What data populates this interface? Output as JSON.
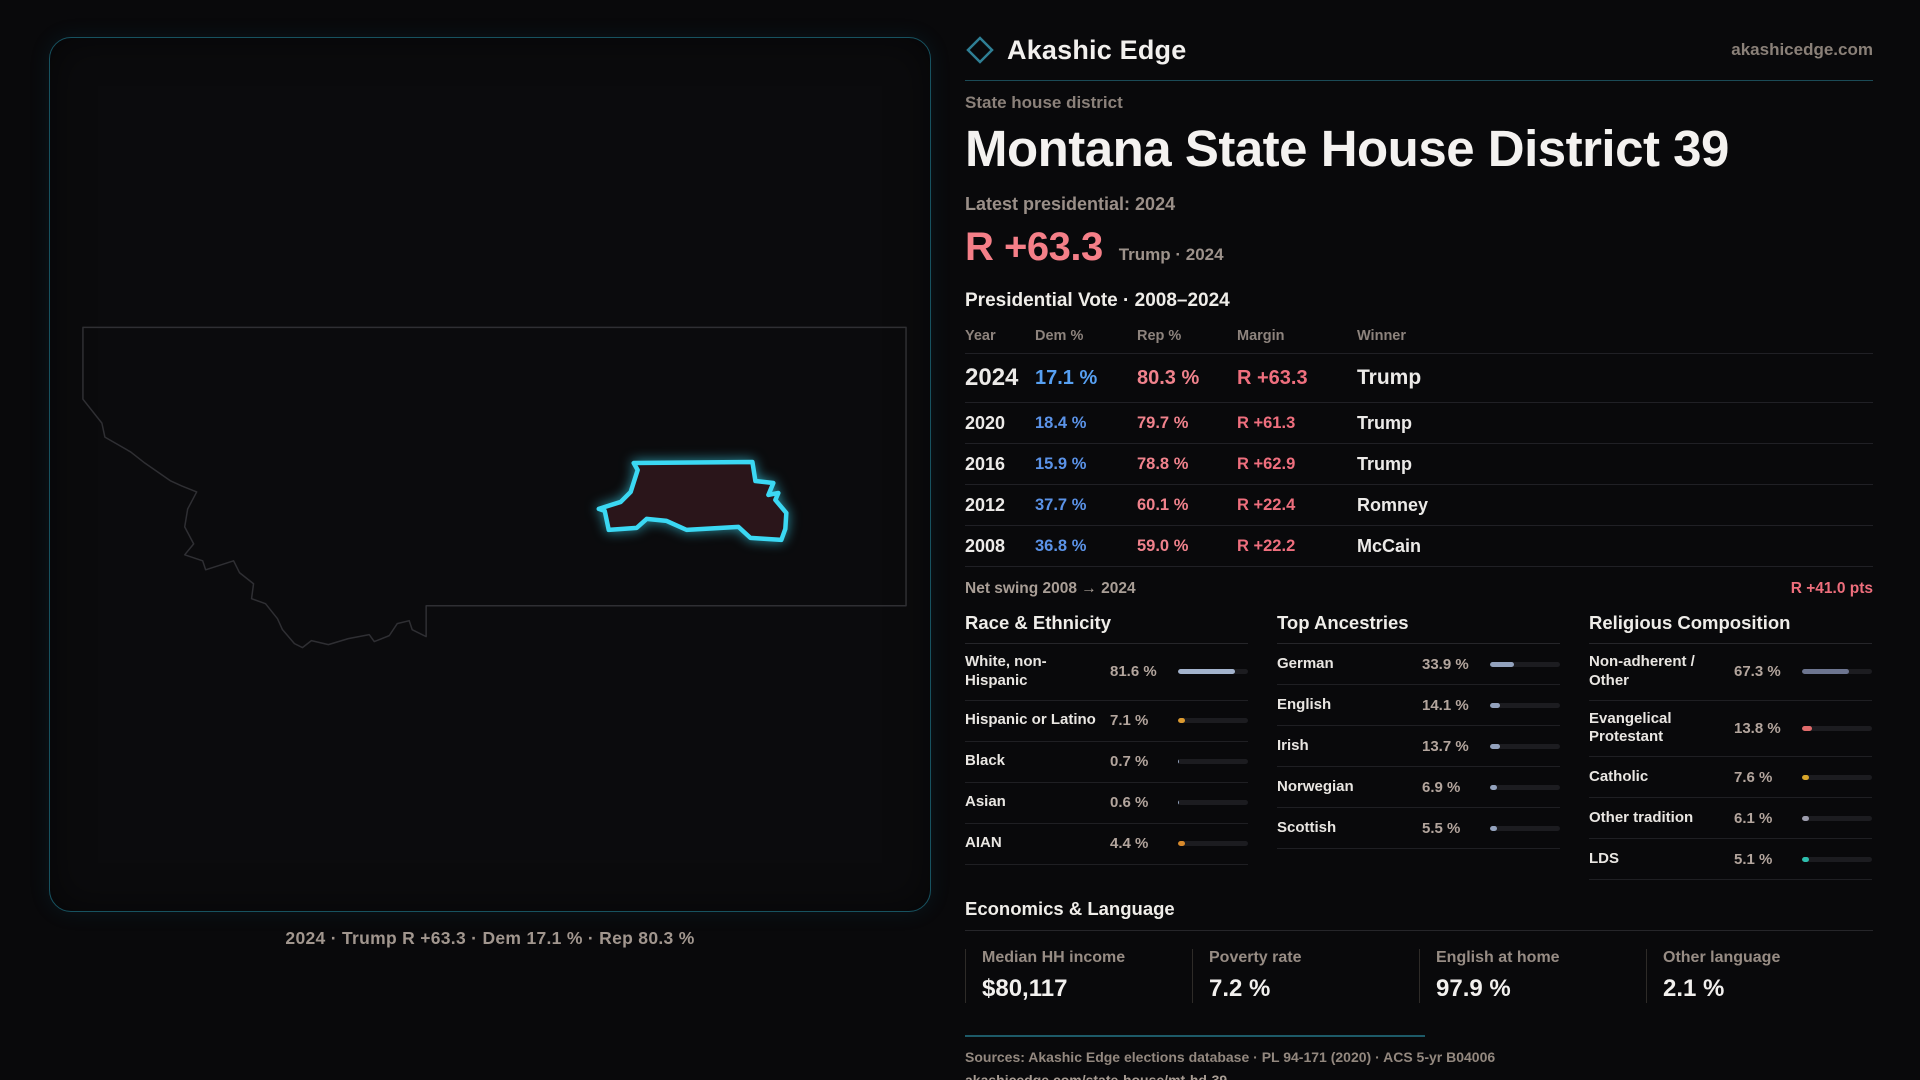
{
  "brand": {
    "name": "Akashic Edge",
    "site": "akashicedge.com",
    "diamond_color": "#2f7f95"
  },
  "header": {
    "kicker": "State house district",
    "title": "Montana State House District 39",
    "latest_label": "Latest presidential: 2024",
    "margin_big": "R +63.3",
    "margin_context": "Trump · 2024"
  },
  "map": {
    "caption": "2024 · Trump R +63.3 · Dem 17.1 % · Rep 80.3 %",
    "district_outline_color": "#3bd8f3",
    "district_fill_color": "#2a151a",
    "state_outline_color": "#2f2f33"
  },
  "table": {
    "title": "Presidential Vote · 2008–2024",
    "columns": [
      "Year",
      "Dem %",
      "Rep %",
      "Margin",
      "Winner"
    ],
    "rows": [
      {
        "year": "2024",
        "dem": "17.1 %",
        "rep": "80.3 %",
        "margin": "R +63.3",
        "winner": "Trump"
      },
      {
        "year": "2020",
        "dem": "18.4 %",
        "rep": "79.7 %",
        "margin": "R +61.3",
        "winner": "Trump"
      },
      {
        "year": "2016",
        "dem": "15.9 %",
        "rep": "78.8 %",
        "margin": "R +62.9",
        "winner": "Trump"
      },
      {
        "year": "2012",
        "dem": "37.7 %",
        "rep": "60.1 %",
        "margin": "R +22.4",
        "winner": "Romney"
      },
      {
        "year": "2008",
        "dem": "36.8 %",
        "rep": "59.0 %",
        "margin": "R +22.2",
        "winner": "McCain"
      }
    ],
    "net_swing_label": "Net swing 2008 → 2024",
    "net_swing_value": "R +41.0 pts"
  },
  "sections": [
    {
      "title": "Race & Ethnicity",
      "rows": [
        {
          "label": "White, non-Hispanic",
          "value": "81.6 %",
          "pct": 81.6,
          "color": "#a3b3cd"
        },
        {
          "label": "Hispanic or Latino",
          "value": "7.1 %",
          "pct": 7.1,
          "color": "#dc9a30"
        },
        {
          "label": "Black",
          "value": "0.7 %",
          "pct": 0.7,
          "color": "#93a2bd"
        },
        {
          "label": "Asian",
          "value": "0.6 %",
          "pct": 0.6,
          "color": "#93a2bd"
        },
        {
          "label": "AIAN",
          "value": "4.4 %",
          "pct": 4.4,
          "color": "#d88a2c"
        }
      ]
    },
    {
      "title": "Top Ancestries",
      "rows": [
        {
          "label": "German",
          "value": "33.9 %",
          "pct": 33.9,
          "color": "#93a2bd"
        },
        {
          "label": "English",
          "value": "14.1 %",
          "pct": 14.1,
          "color": "#93a2bd"
        },
        {
          "label": "Irish",
          "value": "13.7 %",
          "pct": 13.7,
          "color": "#93a2bd"
        },
        {
          "label": "Norwegian",
          "value": "6.9 %",
          "pct": 6.9,
          "color": "#93a2bd"
        },
        {
          "label": "Scottish",
          "value": "5.5 %",
          "pct": 5.5,
          "color": "#93a2bd"
        }
      ]
    },
    {
      "title": "Religious Composition",
      "rows": [
        {
          "label": "Non-adherent / Other",
          "value": "67.3 %",
          "pct": 67.3,
          "color": "#6d7590"
        },
        {
          "label": "Evangelical Protestant",
          "value": "13.8 %",
          "pct": 13.8,
          "color": "#e06b6b"
        },
        {
          "label": "Catholic",
          "value": "7.6 %",
          "pct": 7.6,
          "color": "#d9a62a"
        },
        {
          "label": "Other tradition",
          "value": "6.1 %",
          "pct": 6.1,
          "color": "#9c9cac"
        },
        {
          "label": "LDS",
          "value": "5.1 %",
          "pct": 5.1,
          "color": "#2dbfae"
        }
      ]
    }
  ],
  "economics": {
    "title": "Economics & Language",
    "stats": [
      {
        "label": "Median HH income",
        "value": "$80,117"
      },
      {
        "label": "Poverty rate",
        "value": "7.2 %"
      },
      {
        "label": "English at home",
        "value": "97.9 %"
      },
      {
        "label": "Other language",
        "value": "2.1 %"
      }
    ]
  },
  "footer": {
    "sources": "Sources: Akashic Edge elections database · PL 94-171 (2020) · ACS 5-yr B04006",
    "permalink": "akashicedge.com/state-house/mt-hd-39"
  },
  "chart_data": [
    {
      "type": "table",
      "title": "Presidential Vote · 2008–2024",
      "columns": [
        "Year",
        "Dem %",
        "Rep %",
        "Margin",
        "Winner"
      ],
      "rows": [
        [
          "2024",
          "17.1 %",
          "80.3 %",
          "R +63.3",
          "Trump"
        ],
        [
          "2020",
          "18.4 %",
          "79.7 %",
          "R +61.3",
          "Trump"
        ],
        [
          "2016",
          "15.9 %",
          "78.8 %",
          "R +62.9",
          "Trump"
        ],
        [
          "2012",
          "37.7 %",
          "60.1 %",
          "R +22.4",
          "Romney"
        ],
        [
          "2008",
          "36.8 %",
          "59.0 %",
          "R +22.2",
          "McCain"
        ]
      ],
      "annotations": [
        "Net swing 2008 → 2024: R +41.0 pts"
      ]
    },
    {
      "type": "bar",
      "title": "Race & Ethnicity",
      "categories": [
        "White, non-Hispanic",
        "Hispanic or Latino",
        "Black",
        "Asian",
        "AIAN"
      ],
      "values": [
        81.6,
        7.1,
        0.7,
        0.6,
        4.4
      ],
      "xlabel": "",
      "ylabel": "Percent",
      "xlim": [
        0,
        100
      ]
    },
    {
      "type": "bar",
      "title": "Top Ancestries",
      "categories": [
        "German",
        "English",
        "Irish",
        "Norwegian",
        "Scottish"
      ],
      "values": [
        33.9,
        14.1,
        13.7,
        6.9,
        5.5
      ],
      "xlabel": "",
      "ylabel": "Percent",
      "xlim": [
        0,
        100
      ]
    },
    {
      "type": "bar",
      "title": "Religious Composition",
      "categories": [
        "Non-adherent / Other",
        "Evangelical Protestant",
        "Catholic",
        "Other tradition",
        "LDS"
      ],
      "values": [
        67.3,
        13.8,
        7.6,
        6.1,
        5.1
      ],
      "xlabel": "",
      "ylabel": "Percent",
      "xlim": [
        0,
        100
      ]
    },
    {
      "type": "table",
      "title": "Economics & Language",
      "columns": [
        "Median HH income",
        "Poverty rate",
        "English at home",
        "Other language"
      ],
      "rows": [
        [
          "$80,117",
          "7.2 %",
          "97.9 %",
          "2.1 %"
        ]
      ]
    }
  ]
}
